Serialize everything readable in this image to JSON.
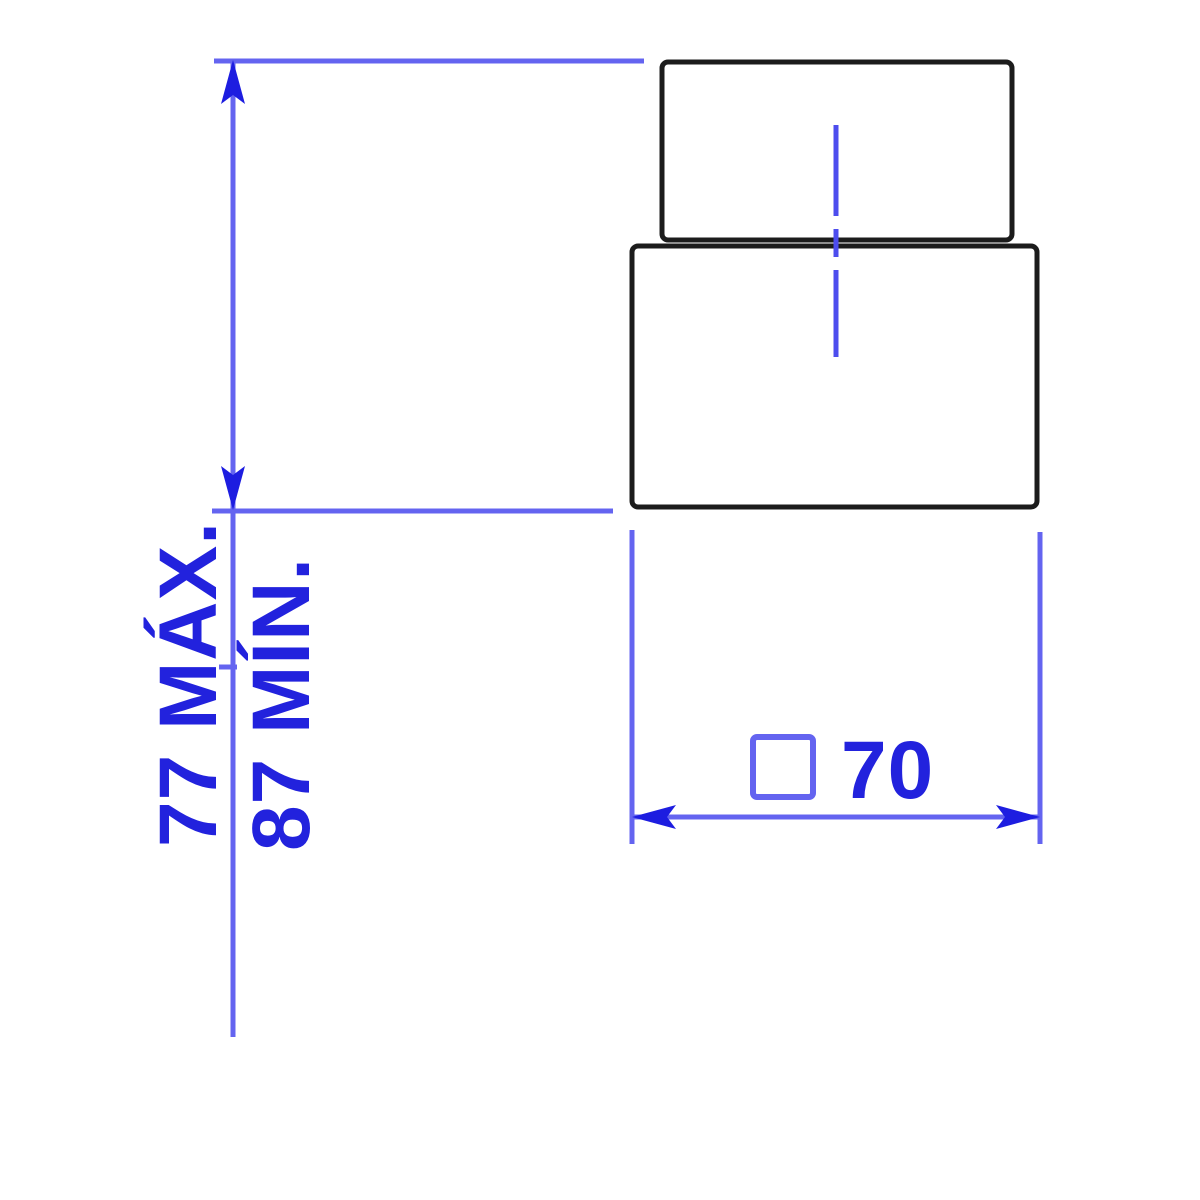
{
  "drawing": {
    "type": "technical-dimension-drawing",
    "view": "front view of stepped square part (cap on base)",
    "colors": {
      "background": "#ffffff",
      "part_outline": "#1c1c1c",
      "dimension_line": "#6464f0",
      "centerline": "#4d4dee",
      "dimension_text": "#2222dd",
      "arrow_fill": "#1d1de0"
    },
    "vertical_dimension": {
      "max_label": "77 MÁX.",
      "min_label": "87 MÍN.",
      "max_value": "77",
      "min_value": "87"
    },
    "horizontal_dimension": {
      "symbol": "□",
      "symbol_meaning": "square-section",
      "value": "70",
      "label": "□ 70"
    }
  }
}
